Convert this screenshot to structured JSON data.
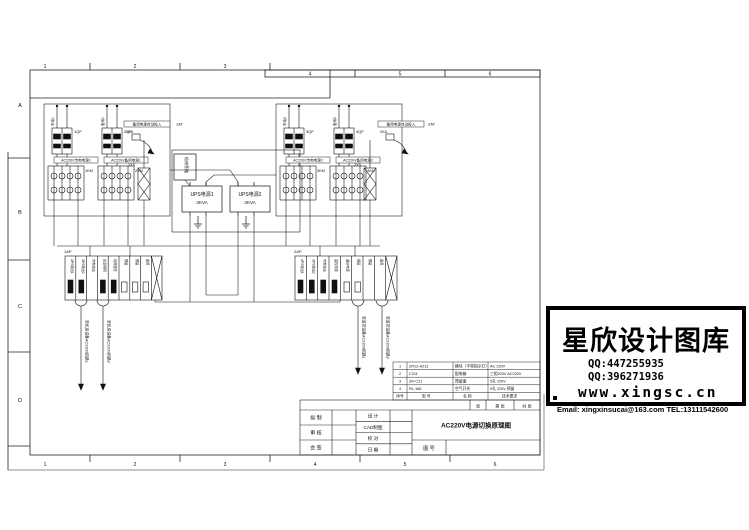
{
  "sheet": {
    "top_numbers": [
      "1",
      "2",
      "3",
      "4",
      "5",
      "6"
    ],
    "bottom_numbers": [
      "1",
      "2",
      "3",
      "4",
      "5",
      "6"
    ],
    "zone_letters": [
      "A",
      "B",
      "C",
      "D"
    ]
  },
  "cabinets": [
    {
      "feeders": [
        {
          "tag": "1QF",
          "vlabel": "市电1",
          "box": "AC220V市电电源1",
          "km": "1KM"
        },
        {
          "tag": "2QF",
          "vlabel": "备用1",
          "box": "AC220V备用电源1",
          "km": "2KM"
        }
      ],
      "ats_tag": "1AT",
      "ats_label": "备用电源自动投入",
      "relay_tag": "1KA",
      "socket_tag": "1XS"
    },
    {
      "feeders": [
        {
          "tag": "3QF",
          "vlabel": "市电2",
          "box": "AC220V市电电源2",
          "km": "3KM"
        },
        {
          "tag": "4QF",
          "vlabel": "备用2",
          "box": "AC220V备用电源2",
          "km": "4KM"
        }
      ],
      "ats_tag": "2AT",
      "ats_label": "备用电源自动投入",
      "relay_tag": "2KA",
      "socket_tag": "2XS"
    }
  ],
  "ups": {
    "bypass_label": "检修旁路",
    "units": [
      {
        "name": "UPS电源1",
        "rating": "3KVA"
      },
      {
        "name": "UPS电源2",
        "rating": "3KVA"
      }
    ]
  },
  "dist": [
    {
      "tag": "1AP",
      "cells": [
        "UPS输出1",
        "UPS输出2",
        "市电输出",
        "应急照明",
        "检修插座",
        "预留",
        "预留",
        "备用"
      ],
      "outs": [
        "至机房设备AC220V回路1",
        "至机房设备AC220V回路2"
      ]
    },
    {
      "tag": "2AP",
      "cells": [
        "UPS输出1",
        "UPS输出2",
        "市电输出",
        "监控电源",
        "通信电源",
        "预留",
        "预留",
        "备用"
      ],
      "outs": [
        "至监控设备AC220V回路1",
        "至监控设备AC220V回路2"
      ]
    }
  ],
  "bom": {
    "rows": [
      {
        "no": "1",
        "model": "ZR12-A212",
        "name": "模块（不带指示灯）",
        "spec": "AC 220V"
      },
      {
        "no": "2",
        "model": "C211",
        "name": "配电箱",
        "spec": "三相220V AC220V"
      },
      {
        "no": "3",
        "model": "ZR-C21",
        "name": "预留盒",
        "spec": "5孔 220V"
      },
      {
        "no": "4",
        "model": "RL-186",
        "name": "空气开关",
        "spec": "5孔 220V 预留"
      }
    ],
    "header": {
      "no": "序号",
      "model": "型 号",
      "name": "名 称",
      "spec": "技术要求"
    }
  },
  "titleblock": {
    "left_rows": [
      "拟 制",
      "审 核",
      "会 签"
    ],
    "mid_rows": [
      "设 计",
      "CAD制图",
      "校 对",
      "日 期"
    ],
    "title": "AC220V电源切换原理图",
    "dno_label": "图 号",
    "strip": [
      "张",
      "第 张",
      "共 张"
    ]
  },
  "watermark": {
    "brand": "星欣设计图库",
    "qq1": "QQ:447255935",
    "qq2": "QQ:396271936",
    "site": "www.xingsc.cn",
    "contact": "Email: xingxinsucai@163.com  TEL:13111542600"
  }
}
